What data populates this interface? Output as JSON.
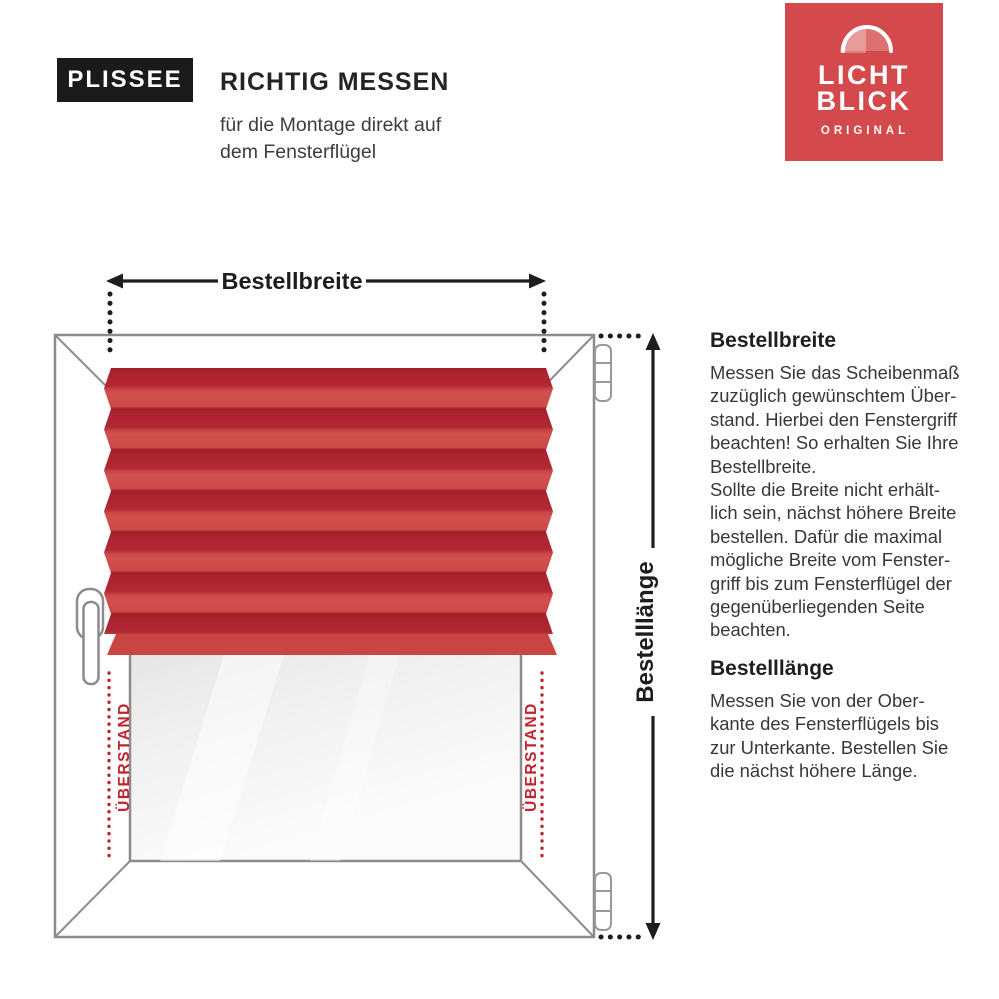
{
  "header": {
    "badge": "PLISSEE",
    "title": "RICHTIG MESSEN",
    "subtitle": "für die Montage direkt auf\ndem Fensterflügel"
  },
  "logo": {
    "line1": "LICHT",
    "line2": "BLICK",
    "subline": "ORIGINAL",
    "bg_color": "#d4494b"
  },
  "diagram": {
    "width_arrow_label": "Bestellbreite",
    "height_arrow_label": "Bestelllänge",
    "overhang_left_label": "ÜBERSTAND",
    "overhang_right_label": "ÜBERSTAND",
    "colors": {
      "pleat_dark": "#ab2330",
      "pleat_light": "#d05150",
      "bottom_rail": "#ca4643",
      "overhang_red": "#c3232c",
      "frame_gray": "#8c8c8c",
      "arrow_black": "#1d1d1d"
    }
  },
  "sections": [
    {
      "heading": "Bestellbreite",
      "body": "Messen Sie das Scheibenmaß\nzuzüglich gewünschtem Über-\nstand. Hierbei den Fenstergriff\nbeachten! So erhalten Sie Ihre\nBestellbreite.\nSollte die Breite nicht erhält-\nlich sein, nächst höhere Breite\nbestellen. Dafür die maximal\nmögliche Breite vom Fenster-\ngriff bis zum Fensterflügel der\ngegenüberliegenden Seite\nbeachten."
    },
    {
      "heading": "Bestelllänge",
      "body": "Messen Sie von der Ober-\nkante des Fensterflügels bis\nzur Unterkante. Bestellen Sie\ndie nächst höhere Länge."
    }
  ]
}
